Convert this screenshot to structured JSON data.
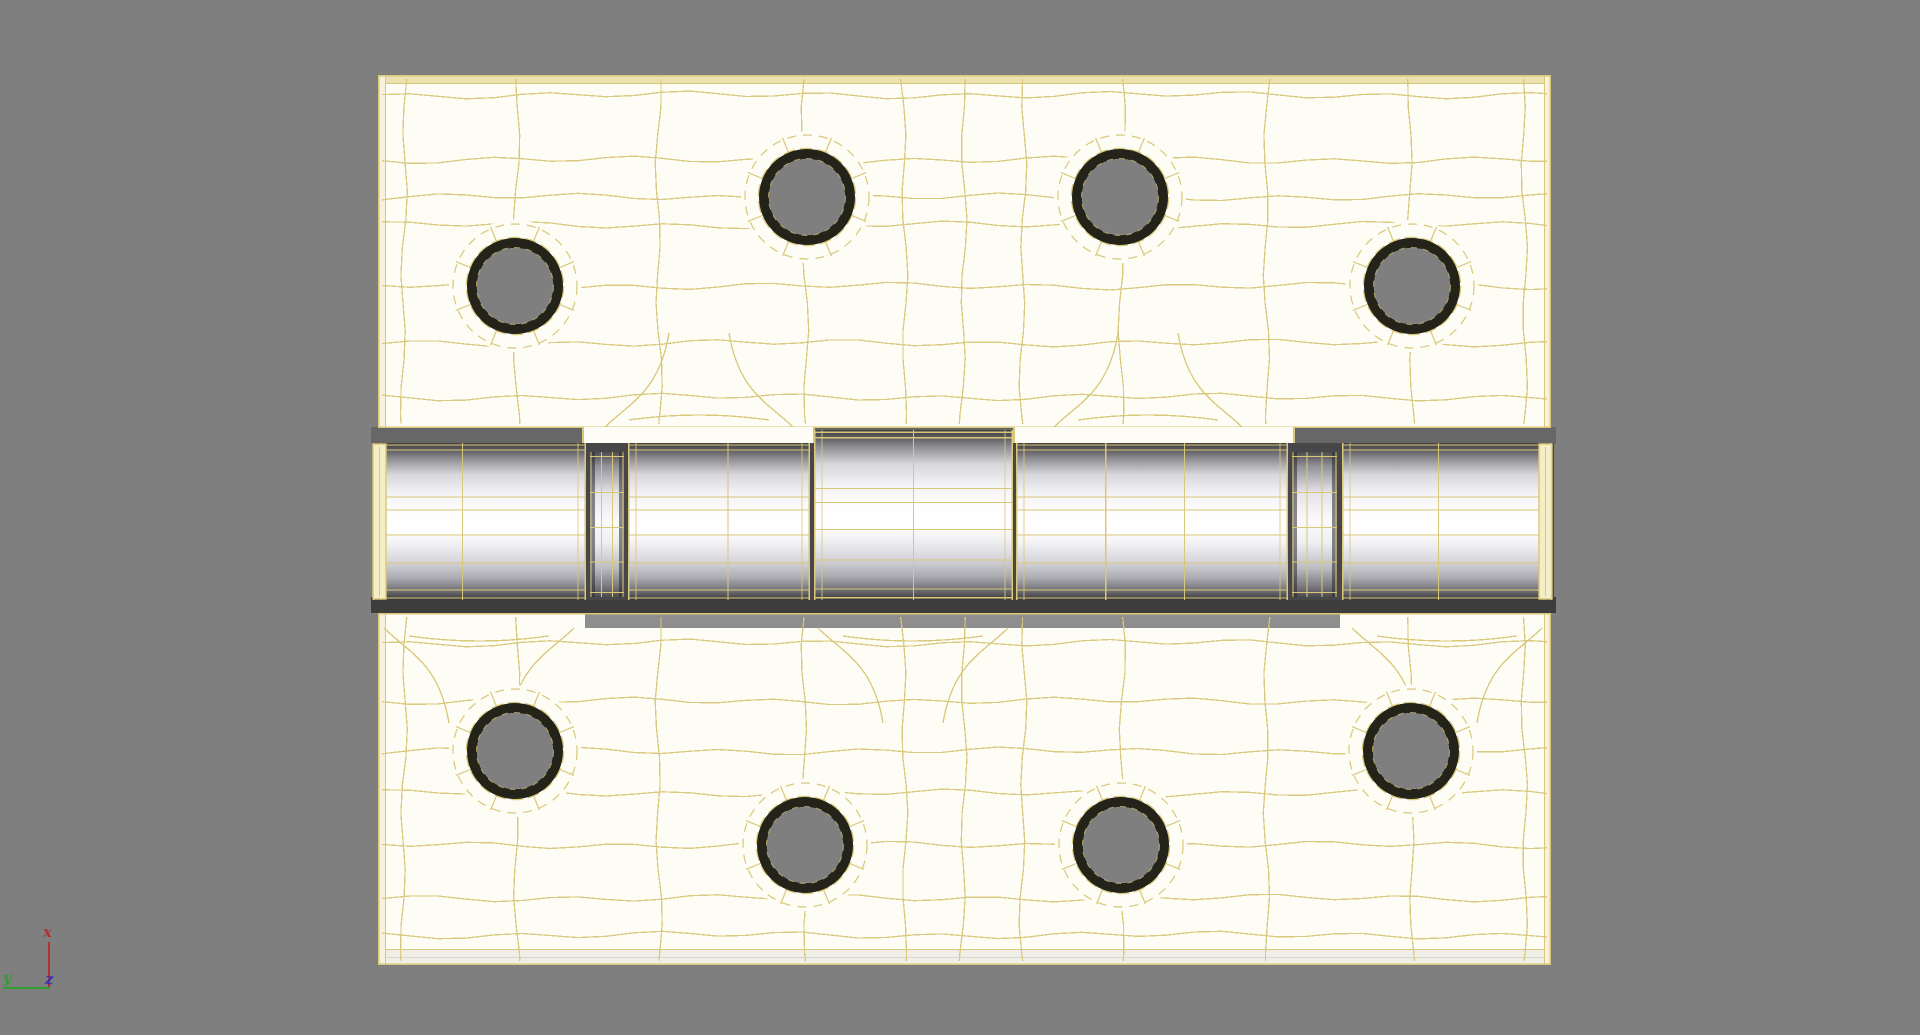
{
  "viewport": {
    "background_color": "#7f7f7f",
    "description": "3D viewport showing a door hinge model, white shaded with tan wireframe overlay"
  },
  "axis_gizmo": {
    "x": {
      "label": "x",
      "color": "#b23232"
    },
    "y": {
      "label": "y",
      "color": "#2f9e2f"
    },
    "z": {
      "label": "z",
      "color": "#3232b2"
    }
  },
  "model": {
    "name": "door-hinge",
    "surface_color": "#fdfdf5",
    "wire_color": "#d9c77a",
    "edge_face_color": "#ece2b0",
    "side_face_color": "#f6f2dd",
    "bottom_face_color": "#efefe8",
    "cap_face_color": "#f4edc6",
    "hole_ring_color": "#23231a",
    "hole_center_color": "#7f7f7f",
    "seam_color": "#47474a",
    "metal_bright": "#ffffff",
    "metal_dark": "#38383a"
  },
  "scene": {
    "hole_radius": 48,
    "plates": {
      "top": {
        "x": 378,
        "y": 75,
        "w": 1173,
        "h": 353,
        "edge": "top",
        "holes": [
          [
            137,
            211
          ],
          [
            429,
            122
          ],
          [
            742,
            122
          ],
          [
            1034,
            211
          ]
        ],
        "grid_x": [
          26,
          139,
          281,
          427,
          526,
          585,
          645,
          744,
          889,
          1033,
          1146
        ],
        "grid_y": [
          20,
          85,
          122,
          150,
          211,
          268,
          322
        ],
        "attach_x": [
          321,
          770
        ],
        "attach_side": "bottom"
      },
      "bottom": {
        "x": 378,
        "y": 613,
        "w": 1173,
        "h": 352,
        "edge": "bottom",
        "holes": [
          [
            137,
            138
          ],
          [
            427,
            232
          ],
          [
            743,
            232
          ],
          [
            1033,
            138
          ]
        ],
        "grid_x": [
          26,
          139,
          281,
          427,
          526,
          585,
          645,
          744,
          889,
          1033,
          1146
        ],
        "grid_y": [
          30,
          88,
          138,
          180,
          232,
          285,
          322
        ],
        "attach_x": [
          101,
          535,
          1069
        ],
        "attach_side": "top",
        "notch": {
          "x": 207,
          "w": 755,
          "h": 15,
          "color": "#8e8e8e"
        }
      }
    },
    "barrel": {
      "x": 371,
      "y": 428,
      "w": 1185,
      "h": 184,
      "segments": [
        {
          "kind": "knuckle",
          "x": 2,
          "w": 213,
          "cap": "left",
          "verts": [
            0.42
          ]
        },
        {
          "kind": "pin",
          "x": 219,
          "w": 34
        },
        {
          "kind": "knuckle",
          "x": 257,
          "w": 182,
          "verts": [
            0.55
          ]
        },
        {
          "kind": "knuckle",
          "x": 443,
          "w": 199,
          "raised": true,
          "verts": [
            0.5
          ]
        },
        {
          "kind": "knuckle",
          "x": 645,
          "w": 272,
          "verts": [
            0.33,
            0.62
          ]
        },
        {
          "kind": "pin",
          "x": 921,
          "w": 45
        },
        {
          "kind": "knuckle",
          "x": 971,
          "w": 210,
          "cap": "right",
          "verts": [
            0.46
          ]
        }
      ]
    },
    "gaps": {
      "top": {
        "x": 371,
        "y": 427,
        "w": 1185,
        "h": 17,
        "color": "#676767"
      },
      "bottom_shadow": {
        "x": 371,
        "y": 597,
        "w": 1185,
        "h": 16,
        "color": "#3d3d3d"
      },
      "tabs": [
        {
          "x": 582,
          "y": 427,
          "w": 233,
          "h": 18
        },
        {
          "x": 1013,
          "y": 427,
          "w": 282,
          "h": 18
        }
      ]
    }
  }
}
